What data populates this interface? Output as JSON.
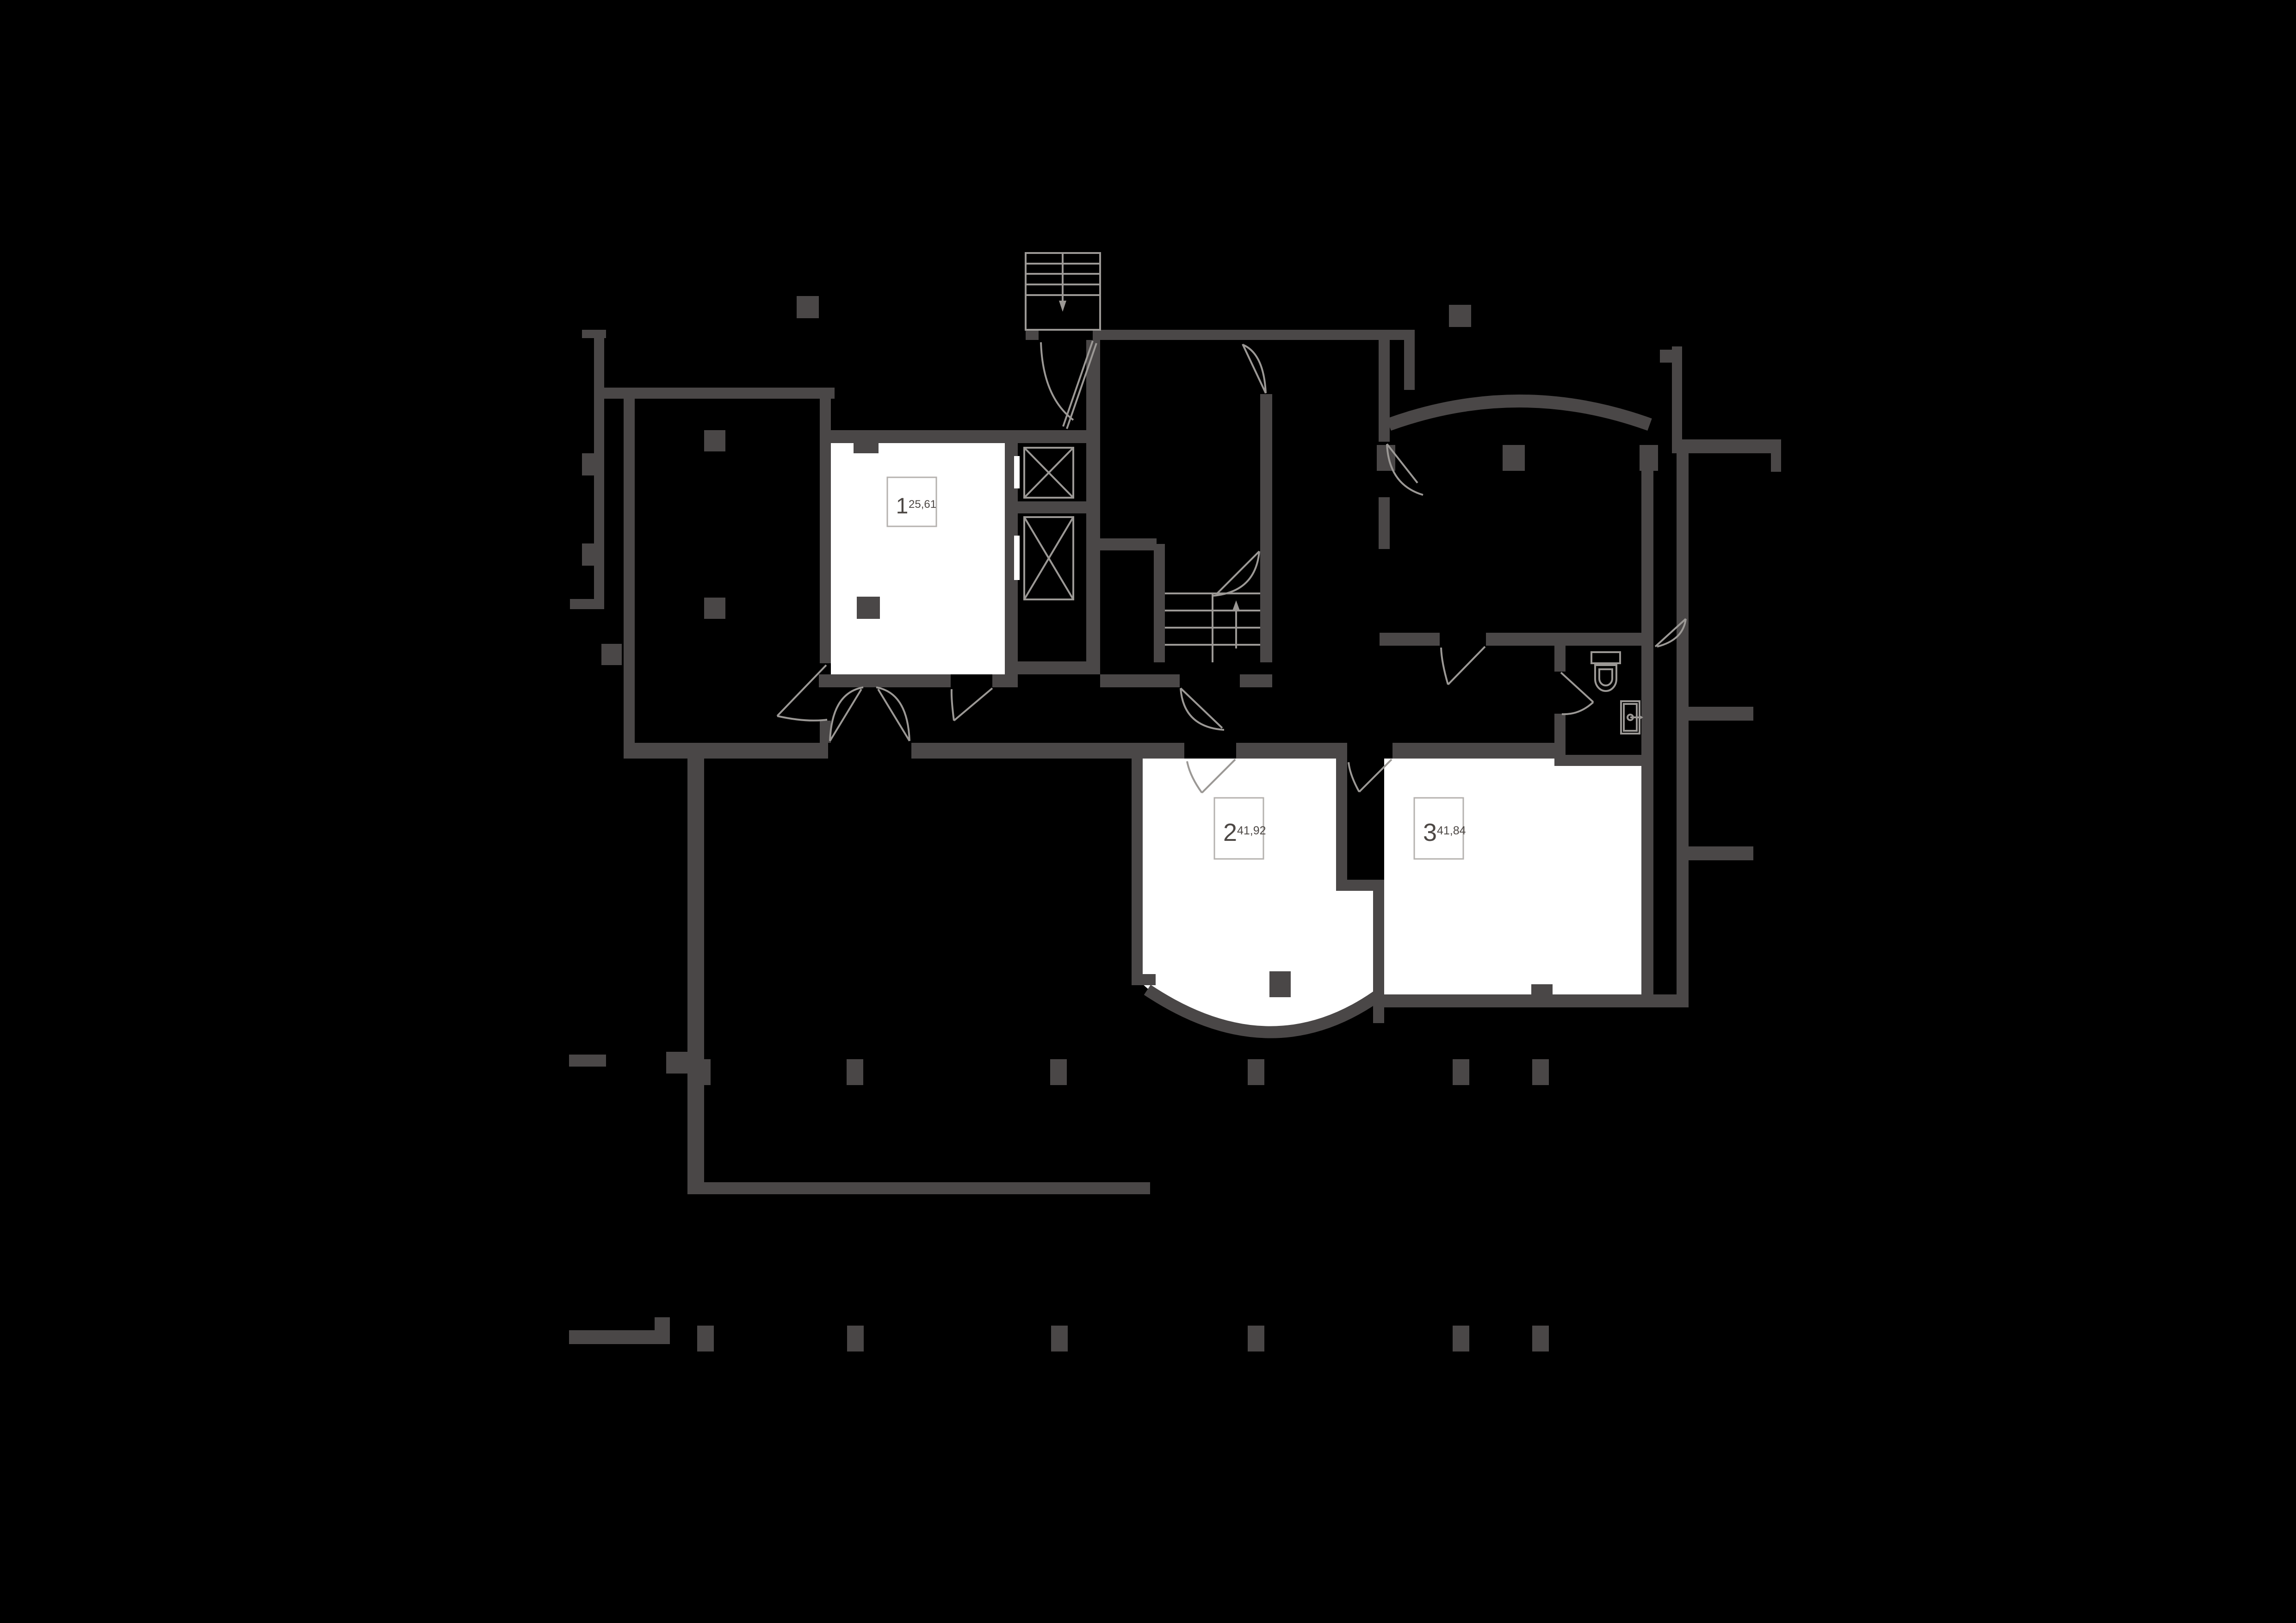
{
  "colors": {
    "background": "#000000",
    "wall": "#4a4747",
    "line": "#9b9895",
    "room_fill": "#ffffff",
    "label_border": "#b5b2af",
    "label_text": "#4d4845"
  },
  "units": [
    {
      "number": "1",
      "area": "25,61"
    },
    {
      "number": "2",
      "area": "41,92"
    },
    {
      "number": "3",
      "area": "41,84"
    }
  ],
  "fixtures": [
    "exterior-stairs",
    "interior-staircase",
    "elevator-upper",
    "elevator-lower",
    "toilet",
    "sink",
    "door-swings",
    "structural-columns"
  ]
}
